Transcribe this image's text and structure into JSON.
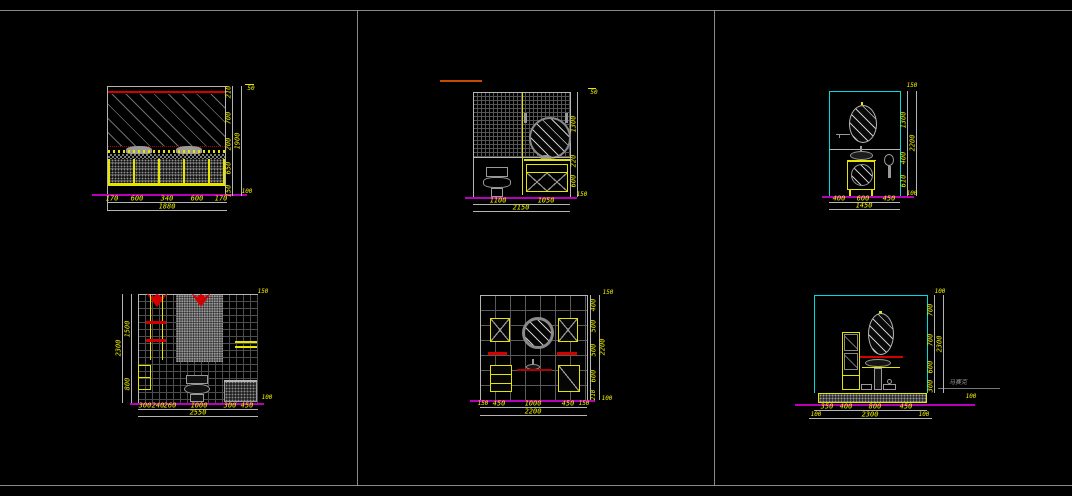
{
  "canvas": {
    "background": "#000000",
    "frame_color": "#8a8a8a"
  },
  "colors": {
    "dimension_text": "#f2f200",
    "outline": "#b5b5b5",
    "cabinet": "#e5e500",
    "accent_red": "#d40000",
    "floor_line": "#b800b8",
    "wall_border": "#00dcdc",
    "fixture": "#9a9a9a"
  },
  "panels": {
    "top_left": {
      "dims_bottom": [
        "170",
        "600",
        "340",
        "600",
        "170"
      ],
      "total_bottom": "1880",
      "dims_right": [
        "210",
        "700",
        "200",
        "650",
        "150"
      ],
      "total_right": "1900",
      "corner_mark": "50",
      "level_mark": "100"
    },
    "top_middle": {
      "dims_bottom": [
        "1100",
        "1050"
      ],
      "total_bottom": "2150",
      "dims_right": [
        "1300",
        "220",
        "600"
      ],
      "corner_mark": "50",
      "level_mark": "150"
    },
    "top_right": {
      "dims_bottom": [
        "400",
        "600",
        "450"
      ],
      "total_bottom": "1450",
      "dims_right": [
        "1300",
        "400",
        "610"
      ],
      "total_right": "2200",
      "corner_mark": "150",
      "level_mark": "100"
    },
    "bottom_left": {
      "dims_bottom": [
        "300",
        "240",
        "260",
        "1000",
        "300",
        "450"
      ],
      "total_bottom": "2550",
      "dims_left": [
        "1500",
        "800"
      ],
      "total_left": "2300",
      "corner_mark": "150",
      "level_mark": "100"
    },
    "bottom_middle": {
      "dims_bottom": [
        "150",
        "450",
        "1000",
        "450",
        "150"
      ],
      "total_bottom": "2200",
      "dims_right": [
        "400",
        "500",
        "500",
        "600",
        "210"
      ],
      "total_right": "2200",
      "corner_mark": "150",
      "level_mark": "100"
    },
    "bottom_right": {
      "dims_bottom": [
        "350",
        "400",
        "800",
        "450"
      ],
      "dims_bottom_overall": [
        "100",
        "2300",
        "100"
      ],
      "dims_right": [
        "700",
        "700",
        "600",
        "300"
      ],
      "total_right": "2300",
      "corner_mark": "100",
      "level_mark": "100",
      "material_note": "马赛克"
    }
  }
}
